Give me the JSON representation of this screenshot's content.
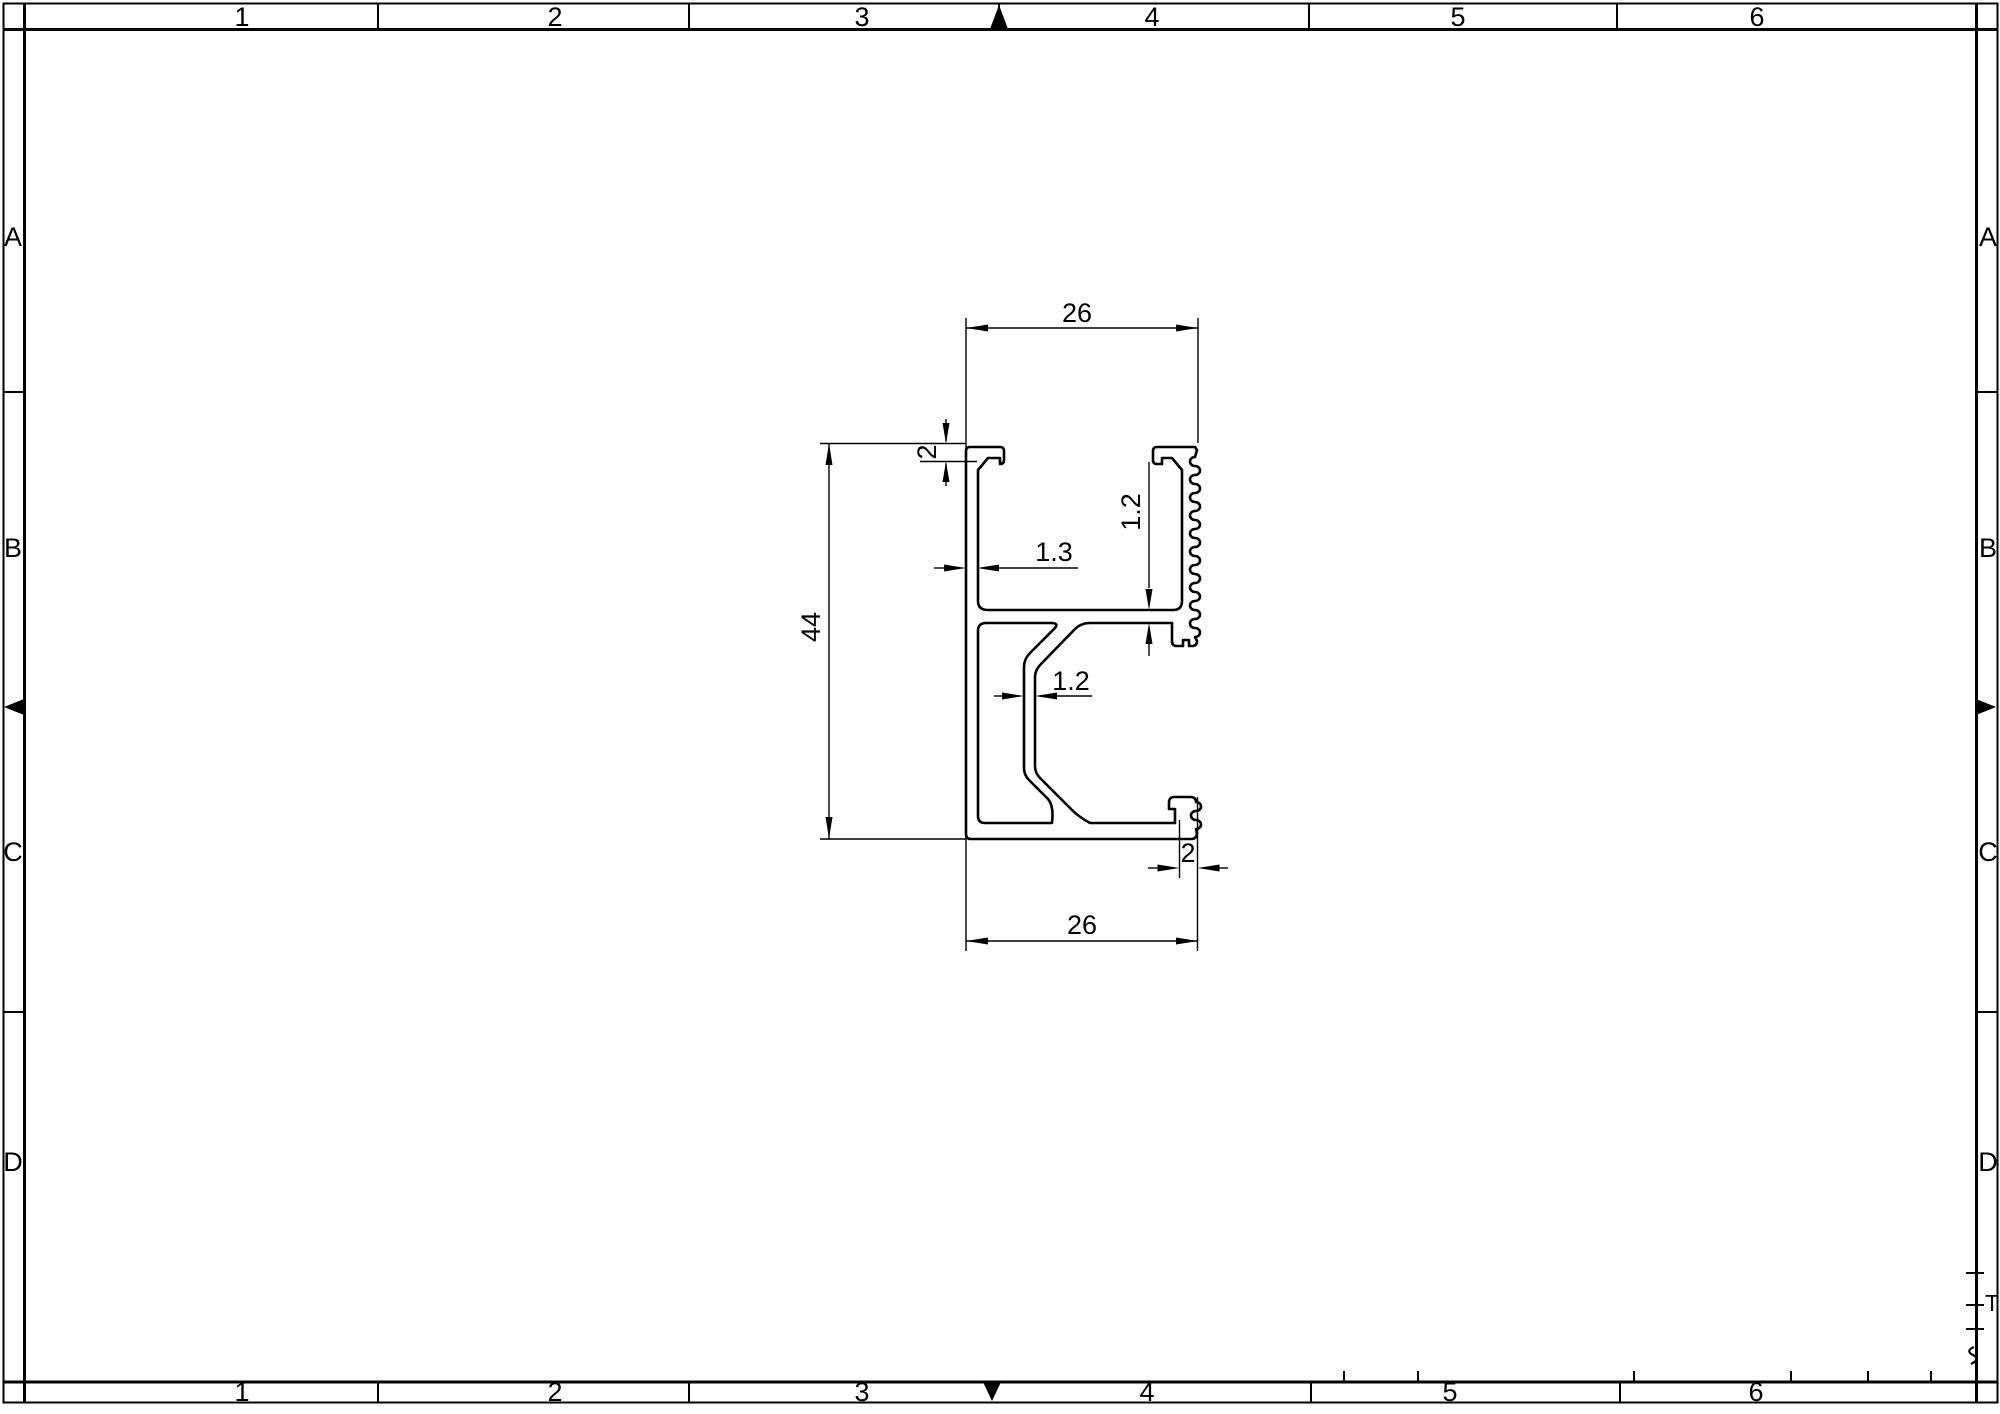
{
  "sheet": {
    "background": "#ffffff",
    "line_color": "#000000",
    "zone_columns_top": [
      "1",
      "2",
      "3",
      "4",
      "5",
      "6"
    ],
    "zone_columns_bottom": [
      "1",
      "2",
      "3",
      "4",
      "5",
      "6"
    ],
    "zone_rows_left": [
      "A",
      "B",
      "C",
      "D"
    ],
    "zone_rows_right": [
      "A",
      "B",
      "C",
      "D"
    ],
    "corner_remnant_text": "T"
  },
  "profile": {
    "description_dimensions": {
      "overall_width_top": "26",
      "overall_width_bottom": "26",
      "overall_height": "44",
      "top_flange_thickness": "2",
      "left_wall_thickness": "1.3",
      "web_thickness": "1.2",
      "inner_wall_thickness": "1.2",
      "bottom_hook_thickness": "2"
    }
  }
}
